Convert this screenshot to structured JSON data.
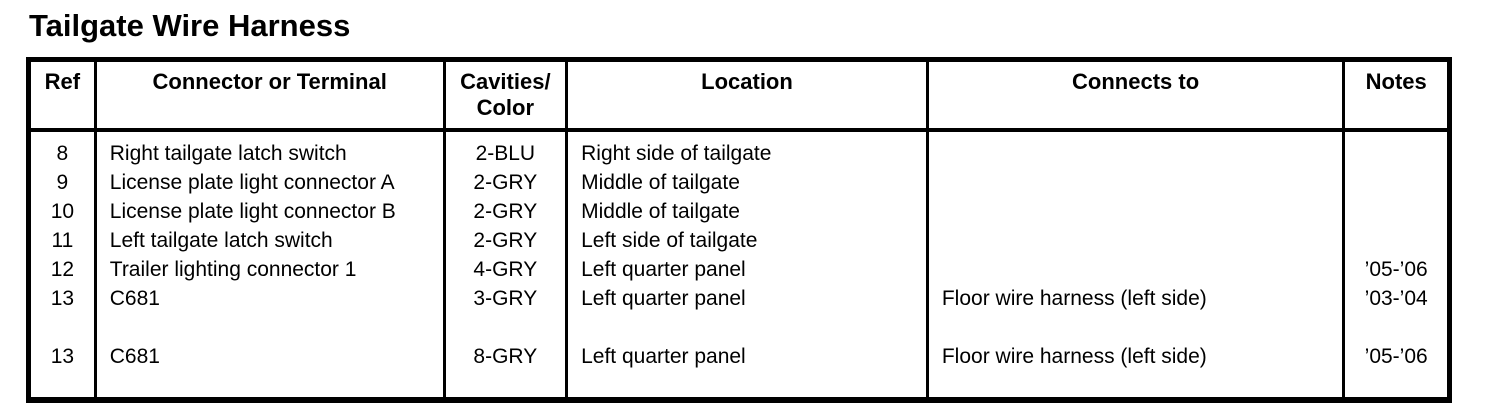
{
  "page": {
    "title": "Tailgate Wire Harness"
  },
  "table": {
    "columns": [
      {
        "key": "ref",
        "label_lines": [
          "Ref"
        ]
      },
      {
        "key": "connector",
        "label_lines": [
          "Connector or Terminal"
        ]
      },
      {
        "key": "cavities",
        "label_lines": [
          "Cavities/",
          "Color"
        ]
      },
      {
        "key": "location",
        "label_lines": [
          "Location"
        ]
      },
      {
        "key": "connects_to",
        "label_lines": [
          "Connects to"
        ]
      },
      {
        "key": "notes",
        "label_lines": [
          "Notes"
        ]
      }
    ],
    "rows": [
      {
        "ref": "8",
        "connector": "Right tailgate latch switch",
        "cavities": "2-BLU",
        "location": "Right side of tailgate",
        "connects_to": "",
        "notes": ""
      },
      {
        "ref": "9",
        "connector": "License plate light connector A",
        "cavities": "2-GRY",
        "location": "Middle of tailgate",
        "connects_to": "",
        "notes": ""
      },
      {
        "ref": "10",
        "connector": "License plate light connector B",
        "cavities": "2-GRY",
        "location": "Middle of tailgate",
        "connects_to": "",
        "notes": ""
      },
      {
        "ref": "11",
        "connector": "Left tailgate latch switch",
        "cavities": "2-GRY",
        "location": "Left side of tailgate",
        "connects_to": "",
        "notes": ""
      },
      {
        "ref": "12",
        "connector": "Trailer lighting connector 1",
        "cavities": "4-GRY",
        "location": "Left quarter panel",
        "connects_to": "",
        "notes": "’05-’06"
      },
      {
        "ref": "13",
        "connector": "C681",
        "cavities": "3-GRY",
        "location": "Left quarter panel",
        "connects_to": "Floor wire harness (left side)",
        "notes": "’03-’04"
      },
      {
        "ref": "",
        "connector": "",
        "cavities": "",
        "location": "",
        "connects_to": "",
        "notes": ""
      },
      {
        "ref": "13",
        "connector": "C681",
        "cavities": "8-GRY",
        "location": "Left quarter panel",
        "connects_to": "Floor wire harness (left side)",
        "notes": "’05-’06"
      }
    ]
  }
}
